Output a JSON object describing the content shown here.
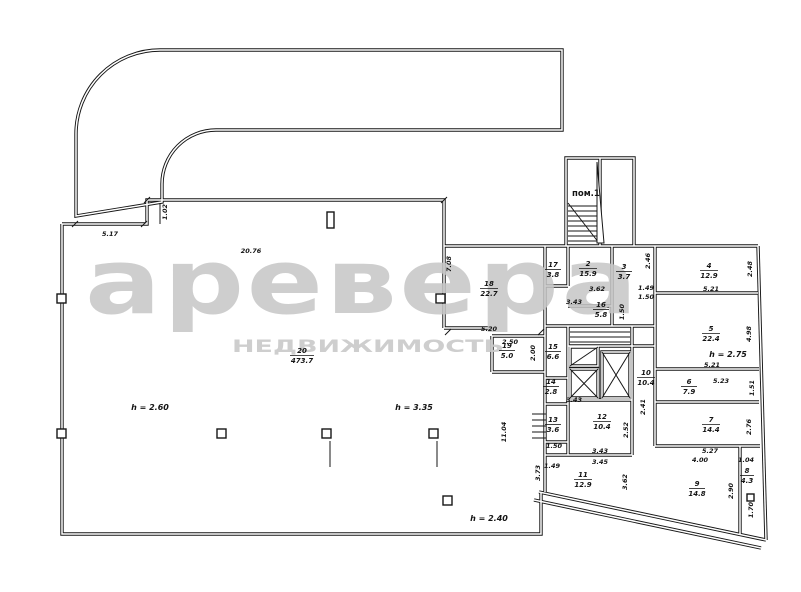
{
  "watermark": {
    "logo": "аревера",
    "subtitle": "НЕДВИЖИМОСТЬ"
  },
  "stairwell": {
    "label": "пом.1"
  },
  "heights": {
    "hall_left": "h = 2.60",
    "hall_right": "h = 3.35",
    "hall_bottom": "h = 2.40",
    "room5": "h = 2.75"
  },
  "rooms": {
    "r2": {
      "num": "2",
      "area": "15.9"
    },
    "r3": {
      "num": "3",
      "area": "3.7"
    },
    "r4": {
      "num": "4",
      "area": "12.9"
    },
    "r5": {
      "num": "5",
      "area": "22.4"
    },
    "r6": {
      "num": "6",
      "area": "7.9"
    },
    "r7": {
      "num": "7",
      "area": "14.4"
    },
    "r8": {
      "num": "8",
      "area": "4.3"
    },
    "r9": {
      "num": "9",
      "area": "14.8"
    },
    "r10": {
      "num": "10",
      "area": "10.4"
    },
    "r11": {
      "num": "11",
      "area": "12.9"
    },
    "r12": {
      "num": "12",
      "area": "10.4"
    },
    "r13": {
      "num": "13",
      "area": "3.6"
    },
    "r14": {
      "num": "14",
      "area": "2.8"
    },
    "r15": {
      "num": "15",
      "area": "6.6"
    },
    "r16": {
      "num": "16",
      "area": "5.8"
    },
    "r17": {
      "num": "17",
      "area": "3.8"
    },
    "r18": {
      "num": "18",
      "area": "22.7"
    },
    "r19": {
      "num": "19",
      "area": "5.0"
    },
    "r20": {
      "num": "20",
      "area": "473.7"
    }
  },
  "dims": {
    "d517": "5.17",
    "d2076": "20.76",
    "d708": "7.08",
    "d102": "1.02",
    "d520": "5.20",
    "d250": "2.50",
    "d200": "2.00",
    "d1104": "11.04",
    "d343a": "3.43",
    "d362a": "3.62",
    "d149a": "1.49",
    "d150a": "1.50",
    "d521a": "5.21",
    "d521b": "5.21",
    "d523": "5.23",
    "d527": "5.27",
    "d400": "4.00",
    "d104": "1.04",
    "d246": "2.46",
    "d248": "2.48",
    "d498": "4.98",
    "d151": "1.51",
    "d276": "2.76",
    "d290": "2.90",
    "d170": "1.70",
    "d150b": "1.50",
    "d149b": "1.49",
    "d343b": "3.43",
    "d345": "3.45",
    "d343c": "3.43",
    "d373": "3.73",
    "d362b": "3.62",
    "d252": "2.52",
    "d241": "2.41",
    "d150c": "1.50"
  },
  "colors": {
    "line": "#161616",
    "watermark": "#c6c6c6",
    "background": "#ffffff"
  }
}
